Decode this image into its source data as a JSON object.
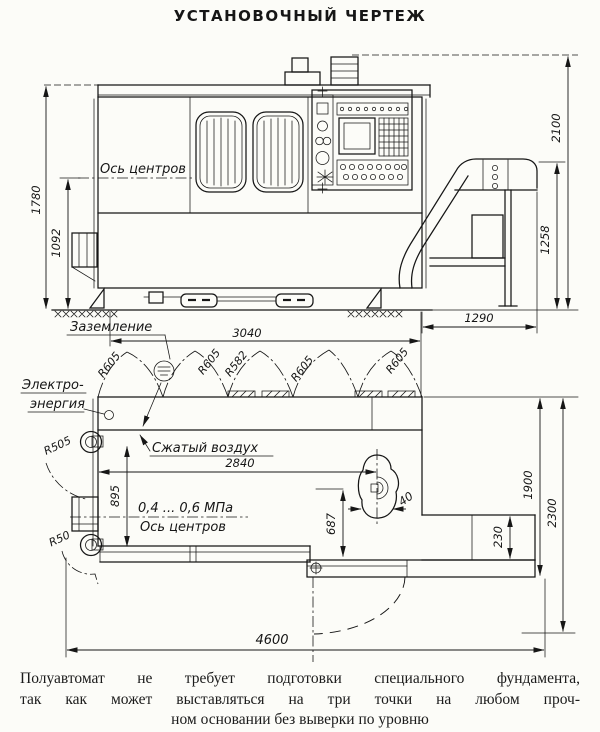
{
  "title": "УСТАНОВОЧНЫЙ ЧЕРТЕЖ",
  "side_view": {
    "axis_label": "Ось центров",
    "ground_label": "Заземление",
    "dims": {
      "overall_height": "2100",
      "body_height": "1780",
      "axis_height": "1092",
      "chute_height": "1258",
      "chute_width": "1290",
      "body_length": "3040"
    }
  },
  "plan_view": {
    "power_label_line1": "Электро-",
    "power_label_line2": "энергия",
    "air_label": "Сжатый воздух",
    "pressure_range": "0,4 ... 0,6 МПа",
    "axis_label": "Ось центров",
    "arc_radii": [
      "R605",
      "R605",
      "R582",
      "R605",
      "R605"
    ],
    "left_radius_top": "R505",
    "left_radius_bottom": "R50",
    "dims": {
      "air_connection_offset": "2840",
      "axis_offset": "895",
      "pedal_offset": "687",
      "pedal_width": "40",
      "step_depth": "230",
      "body_depth": "1900",
      "door_depth": "2300",
      "overall_length": "4600"
    }
  },
  "note_lines": [
    "Полуавтомат не требует подготовки специального фундамента,",
    "так как может выставляться на три точки на любом проч-",
    "ном основании без выверки по уровню"
  ]
}
